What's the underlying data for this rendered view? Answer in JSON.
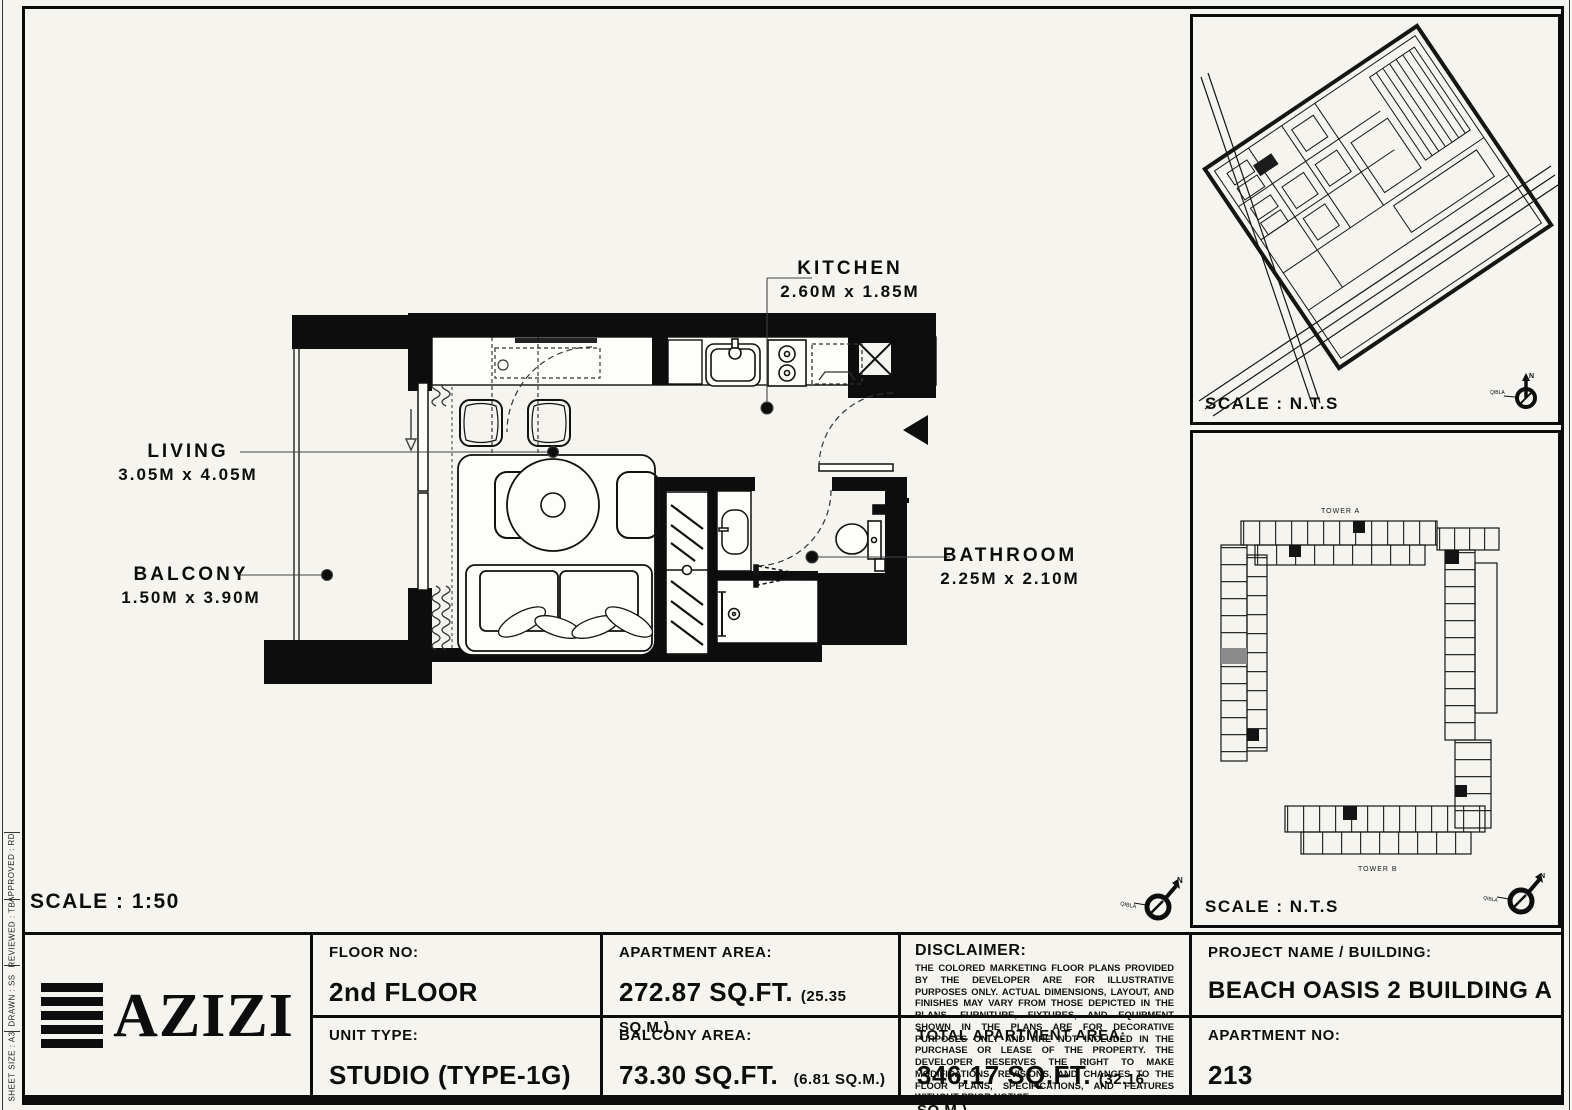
{
  "plan": {
    "scale_label": "SCALE : 1:50",
    "rooms": [
      {
        "id": "kitchen",
        "name": "KITCHEN",
        "dims": "2.60M x 1.85M"
      },
      {
        "id": "living",
        "name": "LIVING",
        "dims": "3.05M x 4.05M"
      },
      {
        "id": "balcony",
        "name": "BALCONY",
        "dims": "1.50M x 3.90M"
      },
      {
        "id": "bathroom",
        "name": "BATHROOM",
        "dims": "2.25M x 2.10M"
      }
    ],
    "compass": {
      "north_label": "N",
      "qibla_label": "QIBLA"
    }
  },
  "site_map_panel": {
    "scale_label": "SCALE : N.T.S"
  },
  "key_plan_panel": {
    "scale_label": "SCALE : N.T.S",
    "tower_a_label": "TOWER A",
    "tower_b_label": "TOWER B"
  },
  "left_strip": {
    "items": [
      "APPROVED : RD",
      "REVIEWED : TB",
      "DRAWN : SS",
      "SHEET SIZE : A3"
    ]
  },
  "title_block": {
    "logo_text": "AZIZI",
    "floor": {
      "label": "FLOOR NO:",
      "value": "2nd FLOOR"
    },
    "unit_type": {
      "label": "UNIT TYPE:",
      "value": "STUDIO (TYPE-1G)"
    },
    "apartment_area": {
      "label": "APARTMENT AREA:",
      "value": "272.87 SQ.FT.",
      "metric": "(25.35 SQ.M.)"
    },
    "balcony_area": {
      "label": "BALCONY AREA:",
      "value": "73.30 SQ.FT.",
      "metric": "(6.81 SQ.M.)"
    },
    "disclaimer": {
      "label": "DISCLAIMER:",
      "text": "THE COLORED MARKETING FLOOR PLANS PROVIDED BY THE DEVELOPER ARE FOR ILLUSTRATIVE PURPOSES ONLY. ACTUAL DIMENSIONS, LAYOUT, AND FINISHES MAY VARY FROM THOSE DEPICTED IN THE PLANS. FURNITURE, FIXTURES, AND EQUIPMENT SHOWN IN THE PLANS ARE FOR DECORATIVE PURPOSES ONLY AND ARE NOT INCLUDED IN THE PURCHASE OR LEASE OF THE PROPERTY. THE DEVELOPER RESERVES THE RIGHT TO MAKE MODIFICATIONS, REVISIONS, AND CHANGES TO THE FLOOR PLANS, SPECIFICATIONS, AND FEATURES WITHOUT PRIOR NOTICE."
    },
    "total_area": {
      "label": "TOTAL APARTMENT AREA:",
      "value": "346.17 SQ.FT.",
      "metric": "(32.16 SQ.M.)"
    },
    "project": {
      "label": "PROJECT NAME / BUILDING:",
      "value": "BEACH OASIS 2 BUILDING A"
    },
    "apartment_no": {
      "label": "APARTMENT NO:",
      "value": "213"
    }
  },
  "colors": {
    "ink": "#0d0d0d",
    "paper": "#f5f4ef",
    "highlight_unit": "#8a8a8a"
  }
}
